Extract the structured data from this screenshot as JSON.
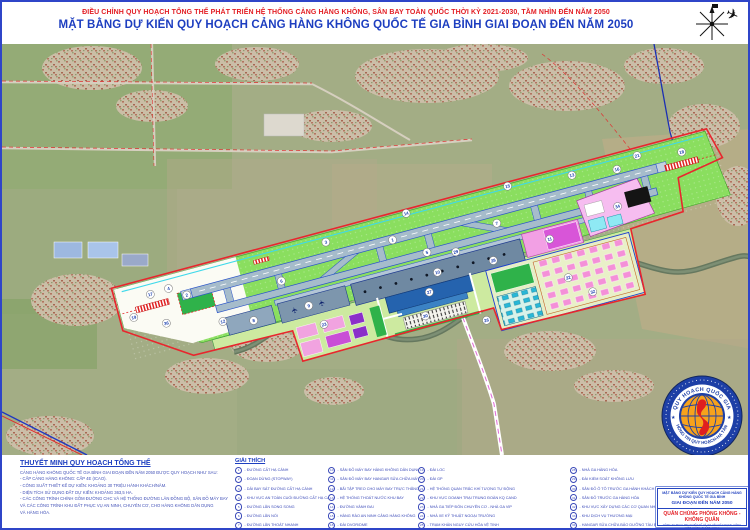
{
  "header": {
    "line1": "ĐIỀU CHỈNH QUY HOẠCH TỔNG THỂ PHÁT TRIỂN HỆ THỐNG CẢNG HÀNG KHÔNG, SÂN BAY TOÀN QUỐC THỜI KỲ 2021-2030, TẦM NHÌN ĐẾN NĂM 2050",
    "line2": "MẶT BẰNG DỰ KIẾN QUY HOẠCH CẢNG HÀNG KHÔNG QUỐC TẾ GIA BÌNH GIAI ĐOẠN ĐẾN NĂM 2050"
  },
  "notes": {
    "title": "THUYẾT MINH QUY HOẠCH TỔNG THỂ",
    "lines": [
      "CẢNG HÀNG KHÔNG QUỐC TẾ GIA BÌNH GIAI ĐOẠN ĐẾN NĂM 2050 ĐƯỢC QUY HOẠCH NHƯ SAU:",
      "- CẤP CẢNG HÀNG KHÔNG: CẤP 4E (ICAO).",
      "- CÔNG SUẤT THIẾT KẾ DỰ KIẾN: KHOẢNG 30 TRIỆU HÀNH KHÁCH/NĂM.",
      "- DIỆN TÍCH SỬ DỤNG ĐẤT DỰ KIẾN: KHOẢNG 363,5 HA.",
      "- CÁC CÔNG TRÌNH CHÍNH GỒM ĐƯỜNG CHC VÀ HỆ THỐNG ĐƯỜNG LĂN ĐỒNG BỘ, SÂN ĐỖ MÁY BAY",
      "VÀ CÁC CÔNG TRÌNH KHU ĐẤT PHỤC VỤ AN NINH, CHUYÊN CƠ, CHO HÀNG KHÔNG DÂN DỤNG",
      "VÀ HÀNG HÓA."
    ]
  },
  "legend": {
    "title": "GIẢI THÍCH",
    "columns": [
      [
        {
          "n": 1,
          "label": "ĐƯỜNG CẤT HẠ CÁNH"
        },
        {
          "n": 2,
          "label": "ĐOẠN DỪNG (STOPWAY)"
        },
        {
          "n": 3,
          "label": "DẢI BAY SÁT ĐƯỜNG CẤT HẠ CÁNH"
        },
        {
          "n": 4,
          "label": "KHU VỰC AN TOÀN CUỐI ĐƯỜNG CẤT HẠ CÁNH (RESA)"
        },
        {
          "n": 5,
          "label": "ĐƯỜNG LĂN SONG SONG"
        },
        {
          "n": 6,
          "label": "ĐƯỜNG LĂN NỐI"
        },
        {
          "n": 7,
          "label": "ĐƯỜNG LĂN THOÁT NHANH"
        },
        {
          "n": 8,
          "label": "SÂN ĐỖ MÁY BAY TRUNG ĐOÀN KQ CAND"
        },
        {
          "n": 9,
          "label": "SÂN ĐỖ MÁY BAY CHUYÊN CƠ"
        }
      ],
      [
        {
          "n": 10,
          "label": "SÂN ĐỖ MÁY BAY HÀNG KHÔNG DÂN DỤNG"
        },
        {
          "n": 11,
          "label": "SÂN ĐỖ MÁY BAY HANGAR SỬA CHỮA MÁY BAY"
        },
        {
          "n": 12,
          "label": "BÃI TẬP TREO CHO MÁY BAY TRỰC THĂNG"
        },
        {
          "n": 13,
          "label": "HỆ THỐNG THOÁT NƯỚC KHU BAY"
        },
        {
          "n": 14,
          "label": "ĐƯỜNG VÀNH ĐAI"
        },
        {
          "n": 15,
          "label": "HÀNG RÀO AN NINH CẢNG HÀNG KHÔNG"
        },
        {
          "n": 16,
          "label": "ĐÀI DVOR/DME"
        },
        {
          "n": 17,
          "label": "HỆ THỐNG ĐÈN TIẾP CẬN CHÍNH XÁC CAT II"
        },
        {
          "n": 18,
          "label": "HỆ THỐNG ĐÈN TIẾP CẬN GIẢN ĐƠN"
        }
      ],
      [
        {
          "n": 19,
          "label": "ĐÀI LOC"
        },
        {
          "n": 20,
          "label": "ĐÀI GP"
        },
        {
          "n": 21,
          "label": "HỆ THỐNG QUAN TRẮC KHÍ TƯỢNG TỰ ĐỘNG"
        },
        {
          "n": 22,
          "label": "KHU VỰC DOANH TRẠI TRUNG ĐOÀN KQ CAND"
        },
        {
          "n": 23,
          "label": "NHÀ GA TIẾP ĐÓN CHUYÊN CƠ - NHÀ GA VIP"
        },
        {
          "n": 24,
          "label": "NHÀ XE KỸ THUẬT NGOẠI TRƯỜNG"
        },
        {
          "n": 25,
          "label": "TRẠM KHẨN NGUY CỨU HỎA VỆ TINH"
        },
        {
          "n": 26,
          "label": "ĐƯỜNG GIAO THÔNG"
        },
        {
          "n": 27,
          "label": "NHÀ GA HÀNH KHÁCH"
        }
      ],
      [
        {
          "n": 28,
          "label": "NHÀ GA HÀNG HÓA"
        },
        {
          "n": 29,
          "label": "ĐÀI KIỂM SOÁT KHÔNG LƯU"
        },
        {
          "n": 30,
          "label": "SÂN ĐỖ Ô TÔ TRƯỚC GA HÀNH KHÁCH"
        },
        {
          "n": 31,
          "label": "SÂN ĐỖ TRƯỚC GA HÀNG HÓA"
        },
        {
          "n": 32,
          "label": "KHU VỰC XÂY DỰNG CÁC CƠ QUAN NHÀ NƯỚC TẠI CHK"
        },
        {
          "n": 33,
          "label": "KHU DỊCH VỤ THƯƠNG MẠI"
        },
        {
          "n": 34,
          "label": "HANGAR SỬA CHỮA BẢO DƯỠNG TÀU BAY"
        },
        {
          "n": 35,
          "label": "KHU CHẾ BIẾN SUẤT ĂN"
        },
        {
          "n": 36,
          "label": "KHU VỰC DỰ TRỮ PHÁT TRIỂN HÀNG KHÔNG DÂN DỤNG"
        }
      ]
    ]
  },
  "titleblock": {
    "line1": "MẶT BẰNG DỰ KIẾN QUY HOẠCH CẢNG HÀNG KHÔNG QUỐC TẾ GIA BÌNH",
    "line2": "GIAI ĐOẠN ĐẾN NĂM 2050",
    "agency": "QUÂN CHỦNG PHÒNG KHÔNG - KHÔNG QUÂN",
    "company": "CÔNG TY TNHH MTV THIẾT KẾ VÀ TƯ VẤN XÂY DỰNG CÔNG TRÌNH HÀNG KHÔNG ADCC"
  },
  "stamp": {
    "top": "QUY HOẠCH QUỐC GIA",
    "bottom": "THÔNG TIN QUY HOẠCH-HẠ TẦNG"
  },
  "map": {
    "markers": [
      {
        "n": 1,
        "x": -30,
        "y": -2
      },
      {
        "n": 2,
        "x": -243,
        "y": -2
      },
      {
        "n": 3,
        "x": -95,
        "y": -17
      },
      {
        "n": 4,
        "x": -259,
        "y": -13
      },
      {
        "n": 5,
        "x": 0,
        "y": 19
      },
      {
        "n": 6,
        "x": -148,
        "y": 9
      },
      {
        "n": 7,
        "x": 75,
        "y": 9
      },
      {
        "n": 8,
        "x": -185,
        "y": 40
      },
      {
        "n": 9,
        "x": -128,
        "y": 40
      },
      {
        "n": 10,
        "x": 5,
        "y": 41
      },
      {
        "n": 11,
        "x": 122,
        "y": 38
      },
      {
        "n": 12,
        "x": -215,
        "y": 33
      },
      {
        "n": 13,
        "x": 160,
        "y": -18
      },
      {
        "n": 14,
        "x": -10,
        "y": -24
      },
      {
        "n": 15,
        "x": 95,
        "y": -24
      },
      {
        "n": 16,
        "x": 205,
        "y": -12
      },
      {
        "n": 17,
        "x": -278,
        "y": -12
      },
      {
        "n": 18,
        "x": 272,
        "y": -12
      },
      {
        "n": 19,
        "x": -300,
        "y": 6
      },
      {
        "n": 21,
        "x": 228,
        "y": -20
      },
      {
        "n": 22,
        "x": 130,
        "y": 80
      },
      {
        "n": 23,
        "x": -118,
        "y": 62
      },
      {
        "n": 26,
        "x": 40,
        "y": 100
      },
      {
        "n": 27,
        "x": -8,
        "y": 58
      },
      {
        "n": 28,
        "x": 62,
        "y": 44
      },
      {
        "n": 29,
        "x": 28,
        "y": 26
      },
      {
        "n": 30,
        "x": -18,
        "y": 80
      },
      {
        "n": 32,
        "x": 150,
        "y": 100
      },
      {
        "n": 34,
        "x": 196,
        "y": 24
      },
      {
        "n": 36,
        "x": -270,
        "y": 20
      }
    ]
  },
  "colors": {
    "title_red": "#e31e24",
    "title_blue": "#1d3ec0",
    "boundary_red": "#e8262d",
    "strip_green": "#8ade5f",
    "runway_gray": "#a6bccb",
    "taxiway_blue": "#2b55c8",
    "apron_pink": "#f2a0e4",
    "stamp_blue": "#1d3fa6",
    "stamp_orange": "#f6a21c"
  },
  "icons": {
    "compass": "compass-north-with-airplane",
    "stamp": "national-planning-seal"
  }
}
